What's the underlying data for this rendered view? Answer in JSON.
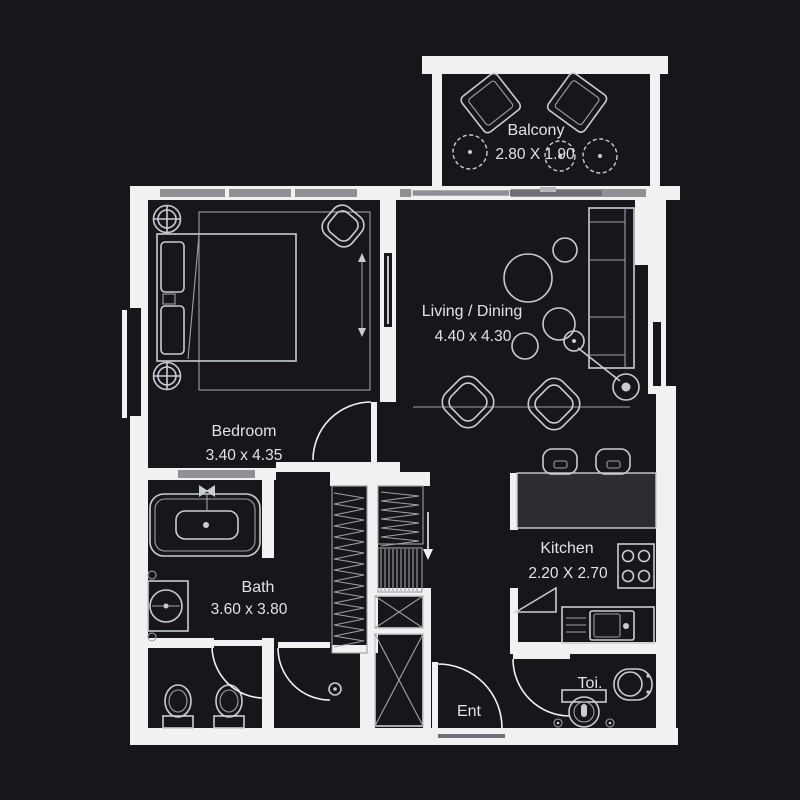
{
  "rooms": {
    "balcony": {
      "label": "Balcony",
      "dims": "2.80 X 1.90"
    },
    "living": {
      "label": "Living / Dining",
      "dims": "4.40 x 4.30"
    },
    "bedroom": {
      "label": "Bedroom",
      "dims": "3.40 x 4.35"
    },
    "bath": {
      "label": "Bath",
      "dims": "3.60 x 3.80"
    },
    "kitchen": {
      "label": "Kitchen",
      "dims": "2.20 X 2.70"
    },
    "toilet": {
      "label": "Toi."
    },
    "entrance": {
      "label": "Ent"
    }
  },
  "colors": {
    "bg": "#17171b",
    "wall": "#f1f1f2",
    "line": "#c9ccd0",
    "line_dim": "#9da1a5",
    "window": "#8e9093",
    "counter": "#2c2c31",
    "text": "#e2e3e4",
    "panel": "#6f7073",
    "tab": "#b7b8ba"
  }
}
